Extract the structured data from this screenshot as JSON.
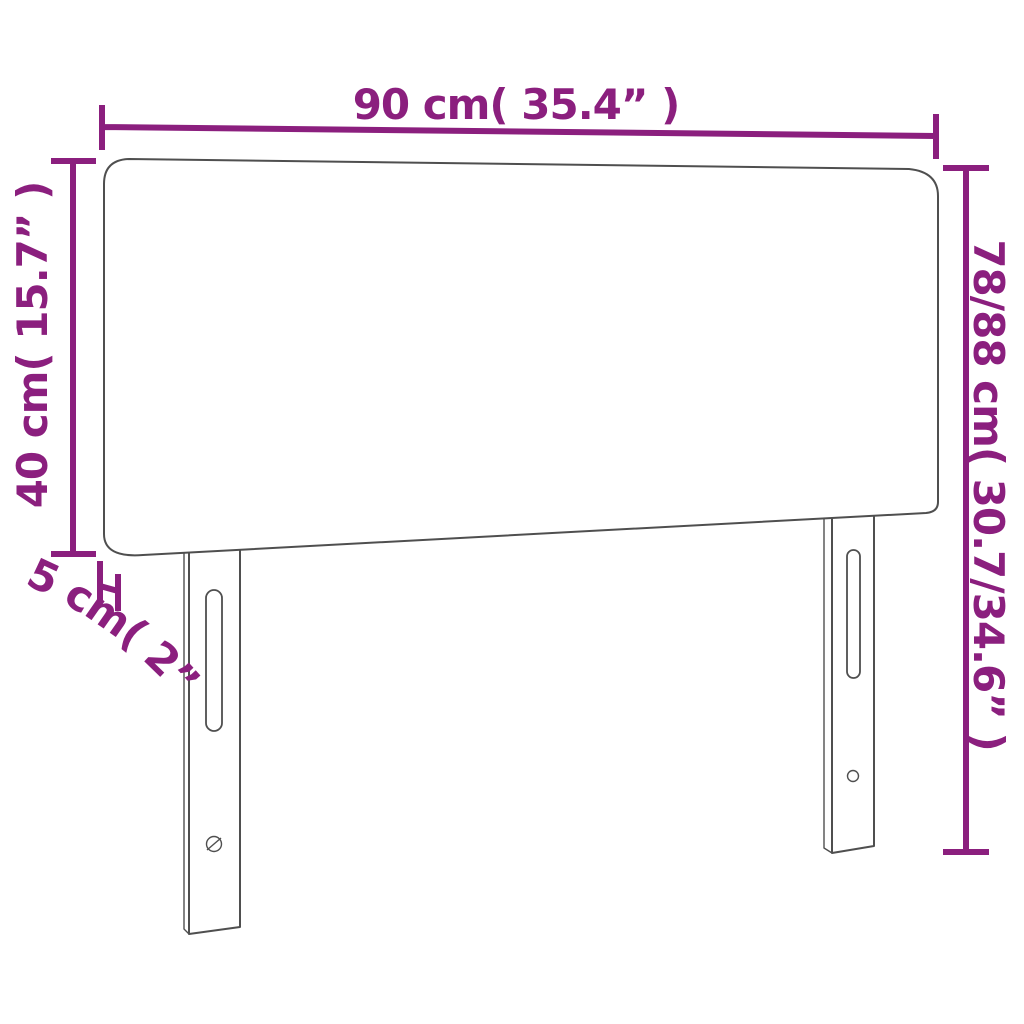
{
  "diagram": {
    "type": "product-dimension-diagram",
    "subject": "headboard",
    "labels": {
      "width": "90 cm( 35.4” )",
      "panel_height": "40 cm( 15.7” )",
      "thickness": "5 cm( 2” )",
      "total_height": "78/88 cm( 30.7/34.6” )"
    },
    "measurements": {
      "width_cm": "90",
      "width_in": "35.4",
      "panel_height_cm": "40",
      "panel_height_in": "15.7",
      "thickness_cm": "5",
      "thickness_in": "2",
      "total_height_cm": "78/88",
      "total_height_in": "30.7/34.6"
    },
    "colors": {
      "dimension_accent": "#8B1F7E",
      "outline": "#4F4F4F",
      "background": "#FFFFFF"
    }
  }
}
